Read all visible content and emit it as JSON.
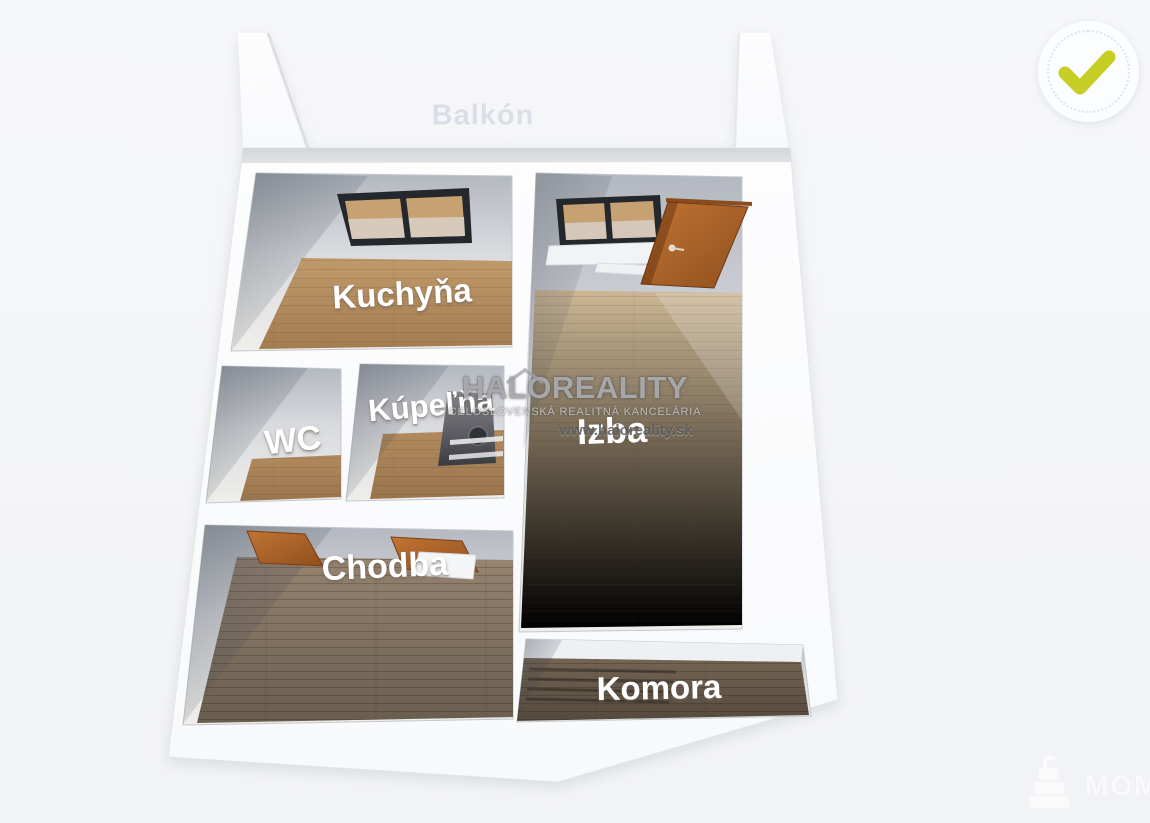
{
  "scene": {
    "background_color": "#f5f6f8"
  },
  "floorplan": {
    "room_labels": [
      {
        "id": "balkon",
        "label": "Balkón"
      },
      {
        "id": "kuchyna",
        "label": "Kuchyňa"
      },
      {
        "id": "izba",
        "label": "Izba"
      },
      {
        "id": "wc",
        "label": "WC"
      },
      {
        "id": "kupelna",
        "label": "Kúpeľňa"
      },
      {
        "id": "chodba",
        "label": "Chodba"
      },
      {
        "id": "komora",
        "label": "Komora"
      }
    ],
    "colors": {
      "wall": "#fcfdfe",
      "wall_shadow": "#b7bbc3",
      "floor_wood_light": "#c7b190",
      "floor_wood_warm": "#b48d61",
      "floor_wood_dark": "#80705f",
      "door_wood": "#b26628",
      "window_frame": "#24272c",
      "label_text": "#ffffff"
    }
  },
  "watermark_center": {
    "brand": "HALOREALITY",
    "subtitle": "CELOSLOVENSKÁ REALITNÁ KANCELÁRIA",
    "website": "www.haloreality.sk"
  },
  "badge_top_right": {
    "type": "verified-checkmark",
    "checkmark_color": "#c4ce25"
  },
  "watermark_bottom_right": {
    "text": "MOM"
  }
}
